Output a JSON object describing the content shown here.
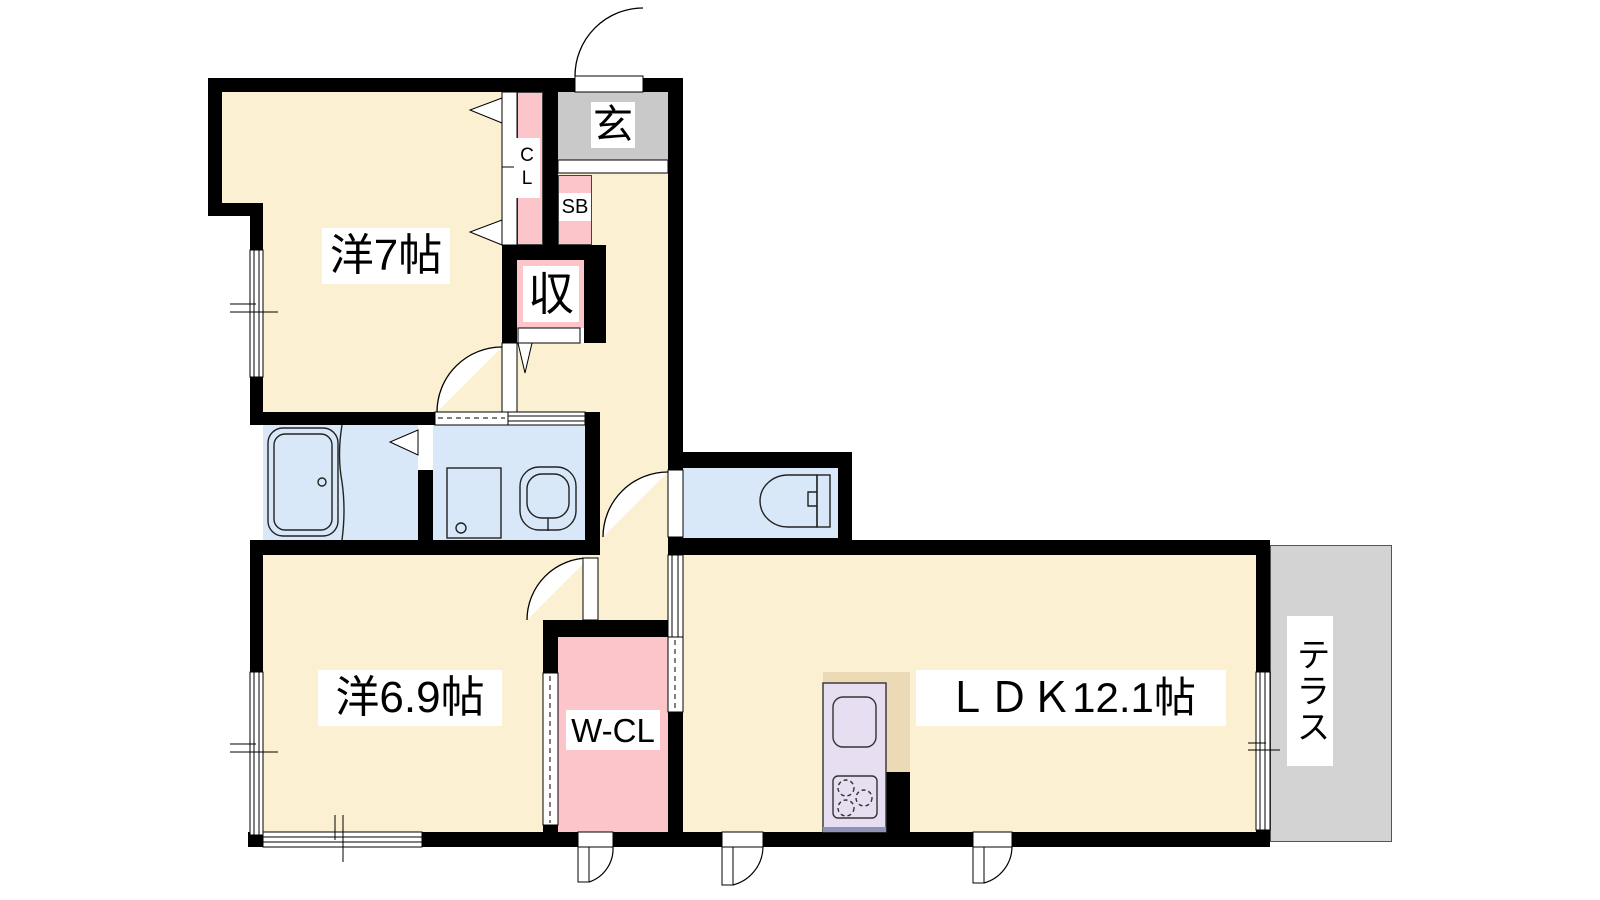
{
  "floorplan": {
    "rooms": {
      "western7": {
        "label": "洋7帖"
      },
      "western69": {
        "label": "洋6.9帖"
      },
      "ldk": {
        "label": "ＬＤＫ12.1帖"
      },
      "entrance": {
        "label": "玄"
      },
      "storage": {
        "label": "収"
      },
      "closet": {
        "label": "CL"
      },
      "shoebox": {
        "label": "SB"
      },
      "walkin_closet": {
        "label": "W-CL"
      },
      "terrace": {
        "label": "テラス"
      }
    },
    "colors": {
      "room_cream": "#fcf0d2",
      "closet_pink": "#fbc5ca",
      "wet_area_blue": "#d9e8f8",
      "entrance_gray": "#c9c9c9",
      "terrace_gray": "#d3d3d3",
      "kitchen_counter_lavender": "#e7def1",
      "kitchen_top_tan": "#ecdab6",
      "wall_black": "#000000"
    }
  }
}
